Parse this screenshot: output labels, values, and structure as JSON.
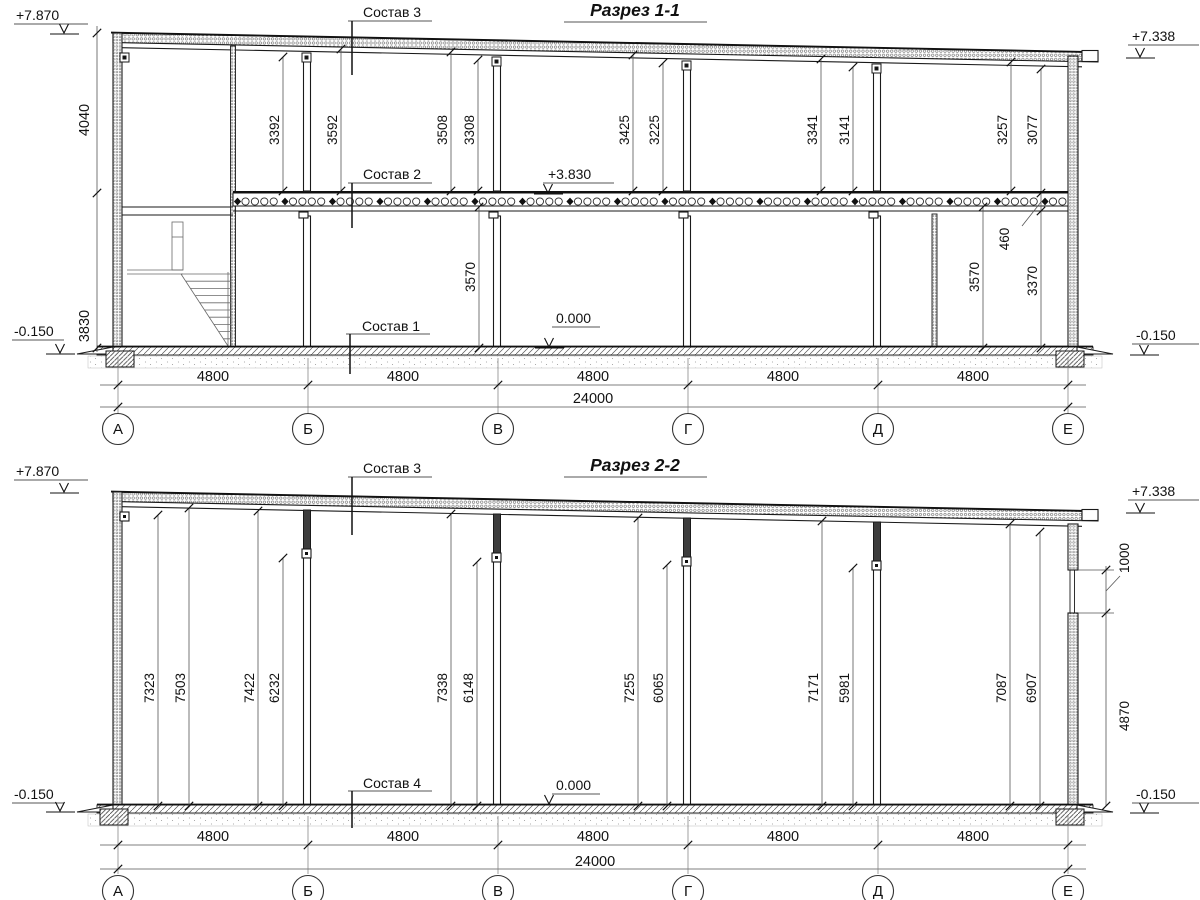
{
  "drawing": {
    "section1": {
      "title": "Разрез 1-1",
      "elev_top_left": "+7.870",
      "elev_top_right": "+7.338",
      "elev_bot_left": "-0.150",
      "elev_bot_right": "-0.150",
      "label_sostav3": "Состав 3",
      "label_sostav2": "Состав 2",
      "label_sostav1": "Состав 1",
      "level_slab": "+3.830",
      "level_floor": "0.000",
      "dim_left_upper": "4040",
      "dim_left_lower": "3830",
      "upper_dims": [
        "3392",
        "3592",
        "3508",
        "3308",
        "3425",
        "3225",
        "3341",
        "3141",
        "3257",
        "3077"
      ],
      "lower_dims": [
        "3570",
        "460",
        "3570",
        "3370"
      ],
      "spans": [
        "4800",
        "4800",
        "4800",
        "4800",
        "4800"
      ],
      "total": "24000",
      "axes": [
        "А",
        "Б",
        "В",
        "Г",
        "Д",
        "Е"
      ]
    },
    "section2": {
      "title": "Разрез 2-2",
      "elev_top_left": "+7.870",
      "elev_top_right": "+7.338",
      "elev_bot_left": "-0.150",
      "elev_bot_right": "-0.150",
      "label_sostav3": "Состав 3",
      "label_sostav4": "Состав 4",
      "level_floor": "0.000",
      "upper_dims": [
        "7323",
        "7503",
        "7422",
        "6232",
        "7338",
        "6148",
        "7255",
        "6065",
        "7171",
        "5981",
        "7087",
        "6907"
      ],
      "right_dims": [
        "1000",
        "4870"
      ],
      "spans": [
        "4800",
        "4800",
        "4800",
        "4800",
        "4800"
      ],
      "total": "24000",
      "axes": [
        "А",
        "Б",
        "В",
        "Г",
        "Д",
        "Е"
      ]
    }
  }
}
